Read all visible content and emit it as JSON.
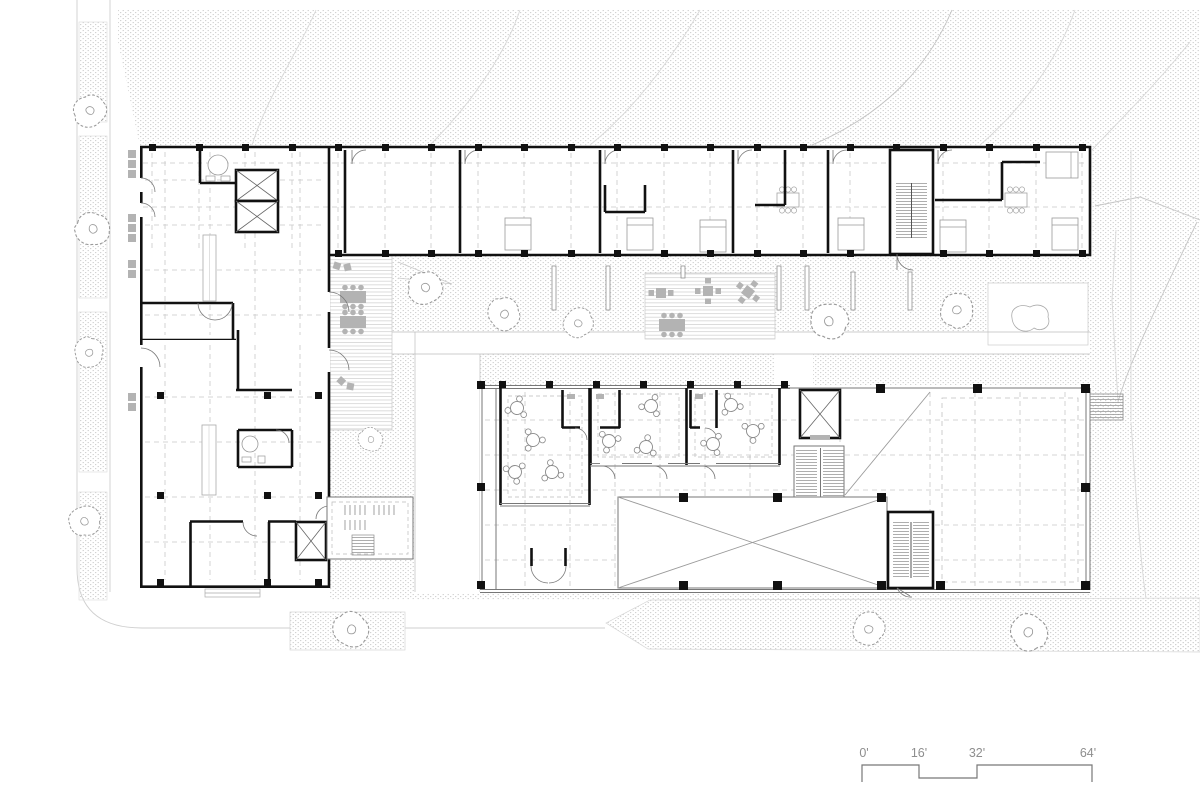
{
  "drawing": {
    "kind": "architectural-site-floor-plan"
  },
  "scale_bar": {
    "labels": [
      "0'",
      "16'",
      "32'",
      "64'"
    ]
  },
  "colors": {
    "background": "#ffffff",
    "wall_black": "#111111",
    "medium_line": "#777777",
    "thin_line": "#9a9a9a",
    "grid_dash": "#c9c9c9",
    "stipple_dot": "#d2d2d2",
    "deck_line": "#d4d4d4",
    "furniture_gray": "#b3b3b3",
    "tree_stroke": "#9a9a9a",
    "scale_text": "#8e8e8e"
  },
  "symbols": {
    "tree": "scribbled-blob-circle",
    "round_table": "circle-with-three-chairs",
    "outdoor_table": "gray-square-with-chairs",
    "elevator": "rect-with-x-diagonals",
    "stair": "parallel-tread-lines",
    "column": "black-square",
    "door": "quarter-arc-swing"
  }
}
